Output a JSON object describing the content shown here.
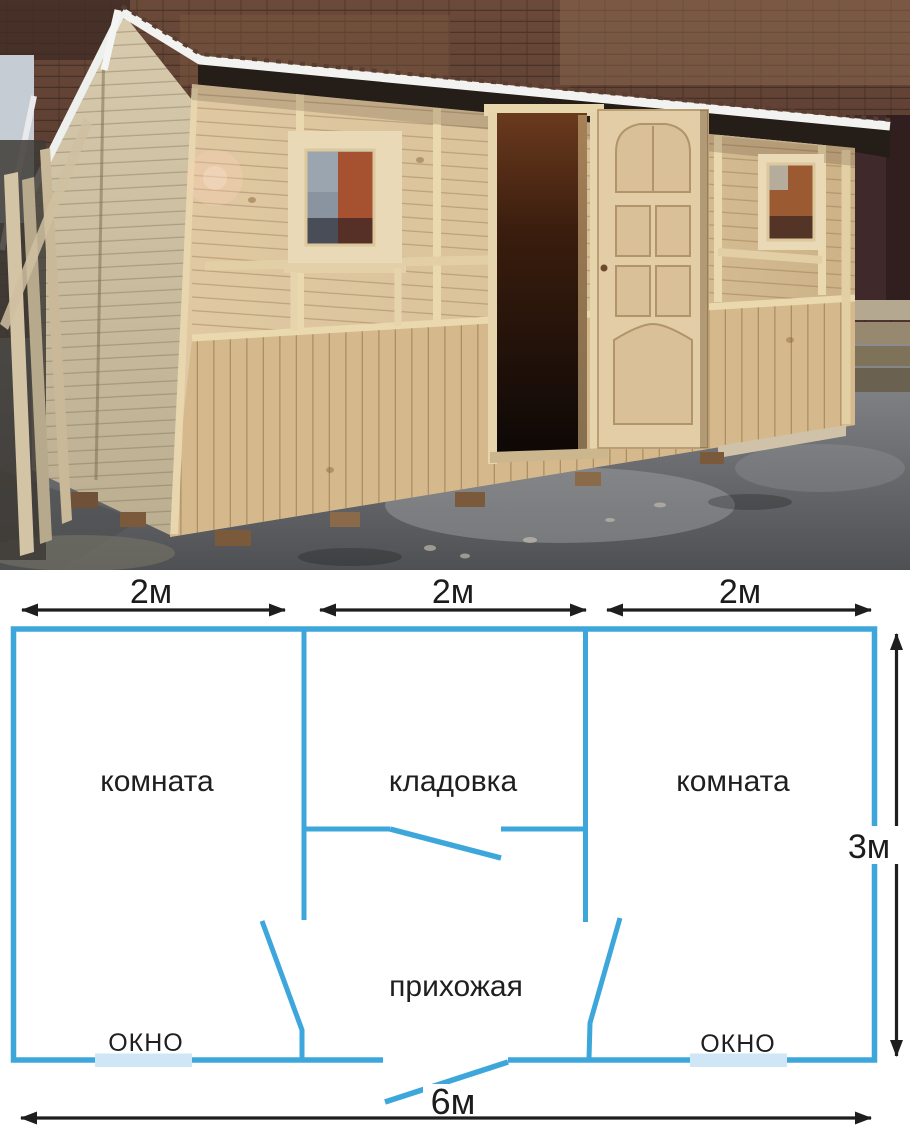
{
  "plan": {
    "labels": {
      "room_left": "комната",
      "storage": "кладовка",
      "room_right": "комната",
      "hallway": "прихожая",
      "window_left": "ОКНО",
      "window_right": "ОКНО"
    },
    "dimensions": {
      "top": [
        "2м",
        "2м",
        "2м"
      ],
      "right": "3м",
      "bottom": "6м"
    },
    "colors": {
      "wall": "#3da7dc",
      "window_fill": "#cfe6f7",
      "dimension": "#1e1e1e",
      "label_text": "#1f1f1f",
      "background": "#ffffff"
    }
  },
  "photo": {
    "colors": {
      "wood_wall": "#d9c29a",
      "wood_wainscot": "#d5b98c",
      "roof_dark": "#241d18",
      "roof_trim_white": "#f2f3f0",
      "brick_background": "#5a3d31",
      "doorway_dark": "#1c1109",
      "ground_asphalt": "#6a6c6f",
      "glass_reflection_orange": "#a65231",
      "glass_reflection_gray": "#8a93a0"
    }
  }
}
